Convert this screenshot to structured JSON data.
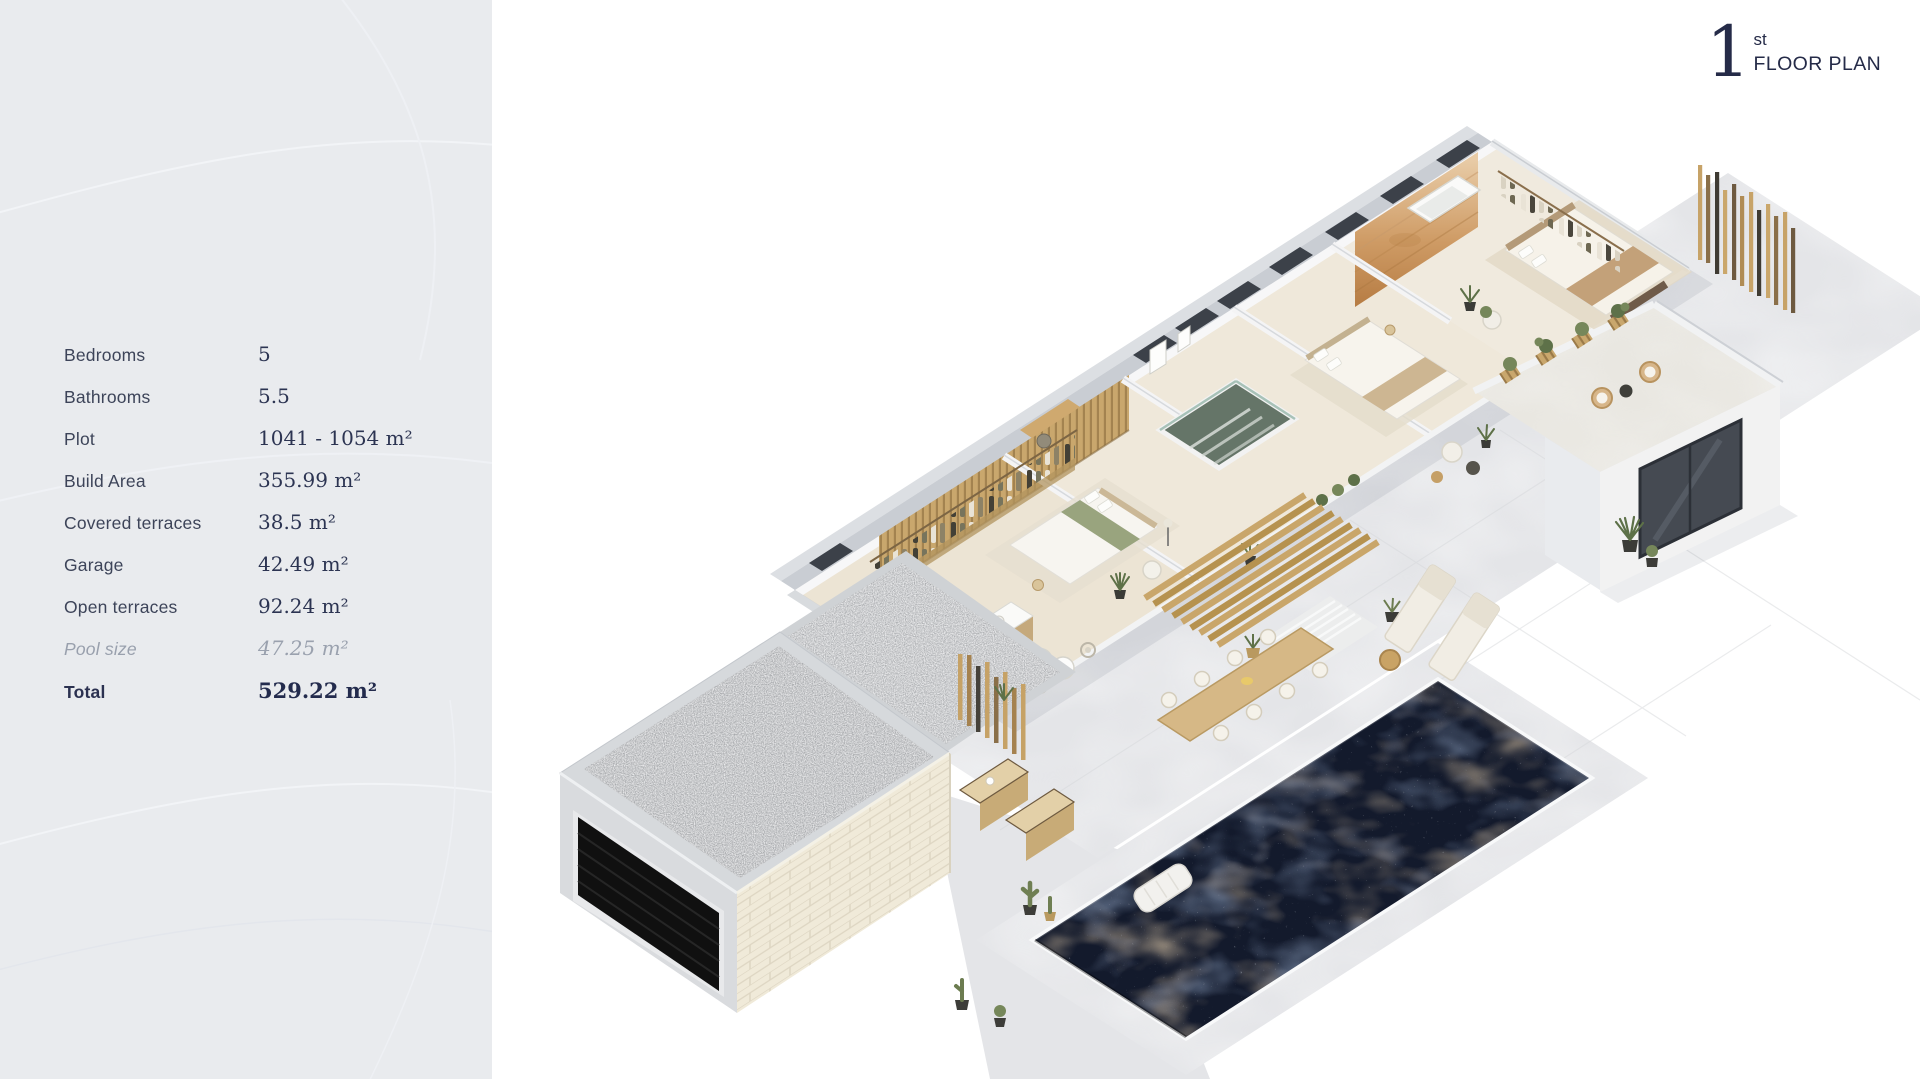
{
  "header": {
    "floor_number": "1",
    "floor_suffix": "st",
    "title": "FLOOR PLAN"
  },
  "panel": {
    "specs": [
      {
        "label": "Bedrooms",
        "value": "5"
      },
      {
        "label": "Bathrooms",
        "value": "5.5"
      },
      {
        "label": "Plot",
        "value": "1041 - 1054 m²"
      },
      {
        "label": "Build Area",
        "value": "355.99 m²"
      },
      {
        "label": "Covered terraces",
        "value": "38.5 m²"
      },
      {
        "label": "Garage",
        "value": "42.49 m²"
      },
      {
        "label": "Open terraces",
        "value": "92.24 m²"
      },
      {
        "label": "Pool size",
        "value": "47.25 m²"
      },
      {
        "label": "Total",
        "value": "529.22 m²"
      }
    ]
  },
  "colors": {
    "panel_bg": "#e9ebee",
    "text_navy": "#2c3452",
    "muted_text": "#9aa1ae",
    "pool_water": "#131a2c",
    "terrace": "#e4e5e8",
    "wood": "#c9a76d",
    "wall_gray": "#c9cdd3",
    "brick": "#f0ead9"
  }
}
